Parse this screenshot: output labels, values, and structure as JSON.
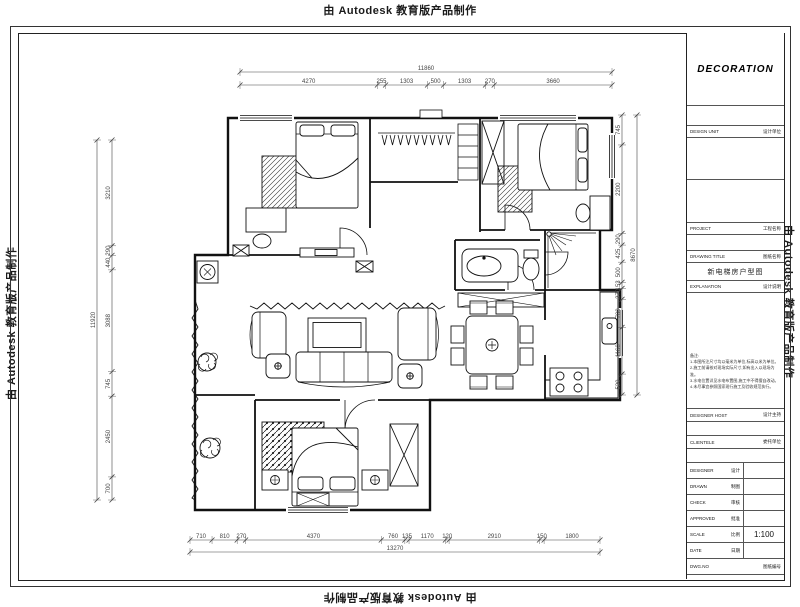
{
  "watermark": {
    "text": "由 Autodesk 教育版产品制作"
  },
  "title_block": {
    "logo": "DECORATION",
    "design_unit_label": "DESIGN UNIT",
    "design_unit_value": "设计单位",
    "project_label": "PROJECT",
    "project_value": "工程名称",
    "drawing_title_label": "DRAWING TITLE",
    "drawing_title_value": "图纸名称",
    "drawing_title_cn": "新电梯房户型图",
    "explanation_label": "EXPLANATION",
    "explanation_value": "设计说明",
    "notes_title": "备注:",
    "notes_lines": [
      "1.本图所注尺寸均以毫米为单位,标高以米为单位。",
      "2.施工前请核对现场实际尺寸,如有出入以现场为准。",
      "3.水电位置详见水电布置图,施工中不得擅自改动。",
      "4.未尽事宜参照国家现行施工及验收规范执行。"
    ],
    "designer_host_label": "DESIGNER HOST",
    "designer_host_value": "设计主持",
    "clientele_label": "CLIENTELE",
    "clientele_value": "委托单位",
    "rows": [
      {
        "label": "DESIGNER",
        "cn": "设计",
        "value": ""
      },
      {
        "label": "DRAWN",
        "cn": "制图",
        "value": ""
      },
      {
        "label": "CHECK",
        "cn": "审核",
        "value": ""
      },
      {
        "label": "APPROVED",
        "cn": "批准",
        "value": ""
      },
      {
        "label": "SCALE",
        "cn": "比例",
        "value": "1:100"
      },
      {
        "label": "DATE",
        "cn": "日期",
        "value": ""
      }
    ],
    "dwg_label": "DWG.NO",
    "dwg_value": "图纸编号"
  },
  "dimensions": {
    "top_overall": "11860",
    "top_chain": [
      "4270",
      "255",
      "1303",
      "500",
      "1303",
      "270",
      "3660"
    ],
    "left_overall": "11920",
    "left_chain": [
      "3210",
      "290",
      "440",
      "3088",
      "745",
      "2450",
      "700"
    ],
    "right_overall": "8670",
    "right_chain": [
      "745",
      "2200",
      "290",
      "425",
      "500",
      "153",
      "270",
      "700",
      "1160",
      "520"
    ],
    "bottom_overall": "13270",
    "bottom_chain": [
      "710",
      "810",
      "270",
      "4370",
      "760",
      "135",
      "1170",
      "120",
      "2910",
      "150",
      "1800"
    ]
  },
  "colors": {
    "line": "#111111",
    "dim": "#444444",
    "paper": "#ffffff"
  }
}
